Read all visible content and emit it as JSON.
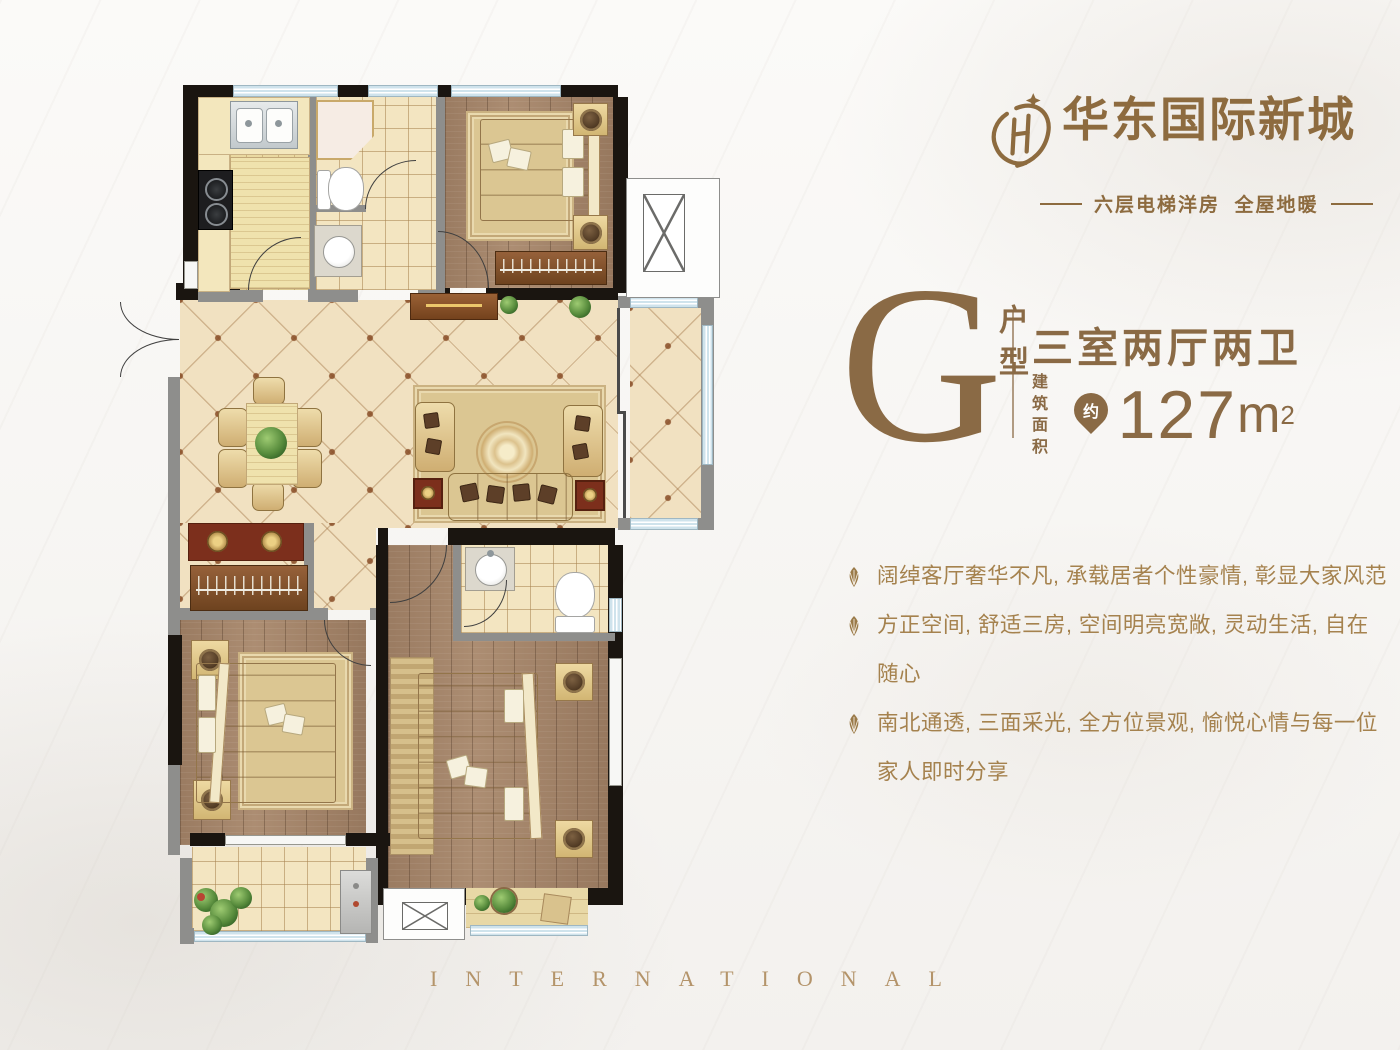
{
  "brand": {
    "name": "华东国际新城",
    "tagline": "六层电梯洋房  全屋地暖"
  },
  "unit": {
    "letter": "G",
    "letter_label": "户型",
    "layout": "三室两厅两卫",
    "area_label": "建筑面积",
    "area_approx": "约",
    "area_value": "127",
    "area_unit": "m",
    "area_power": "2"
  },
  "features": [
    {
      "text": "阔绰客厅奢华不凡, 承载居者个性豪情, 彰显大家风范"
    },
    {
      "text": "方正空间, 舒适三房, 空间明亮宽敞, 灵动生活, 自在随心"
    },
    {
      "text": "南北通透, 三面采光, 全方位景观, 愉悦心情与每一位家人即时分享"
    }
  ],
  "footer": {
    "caption": "INTERNATIONAL"
  },
  "colors": {
    "accent_bronze": "#8a6a45",
    "feature_gold": "#a5824e",
    "logo_gold": "#8d6b3f",
    "footer_gold": "#b4946a",
    "wall_black": "#1a1510",
    "wall_gray": "#8e8e8c",
    "window_blue": "#cfe3ec"
  },
  "icons": {
    "brand_mark": "huadong-monogram-icon",
    "feature_bullet": "fan-leaf-icon",
    "area_marker": "pin-approx-icon"
  }
}
